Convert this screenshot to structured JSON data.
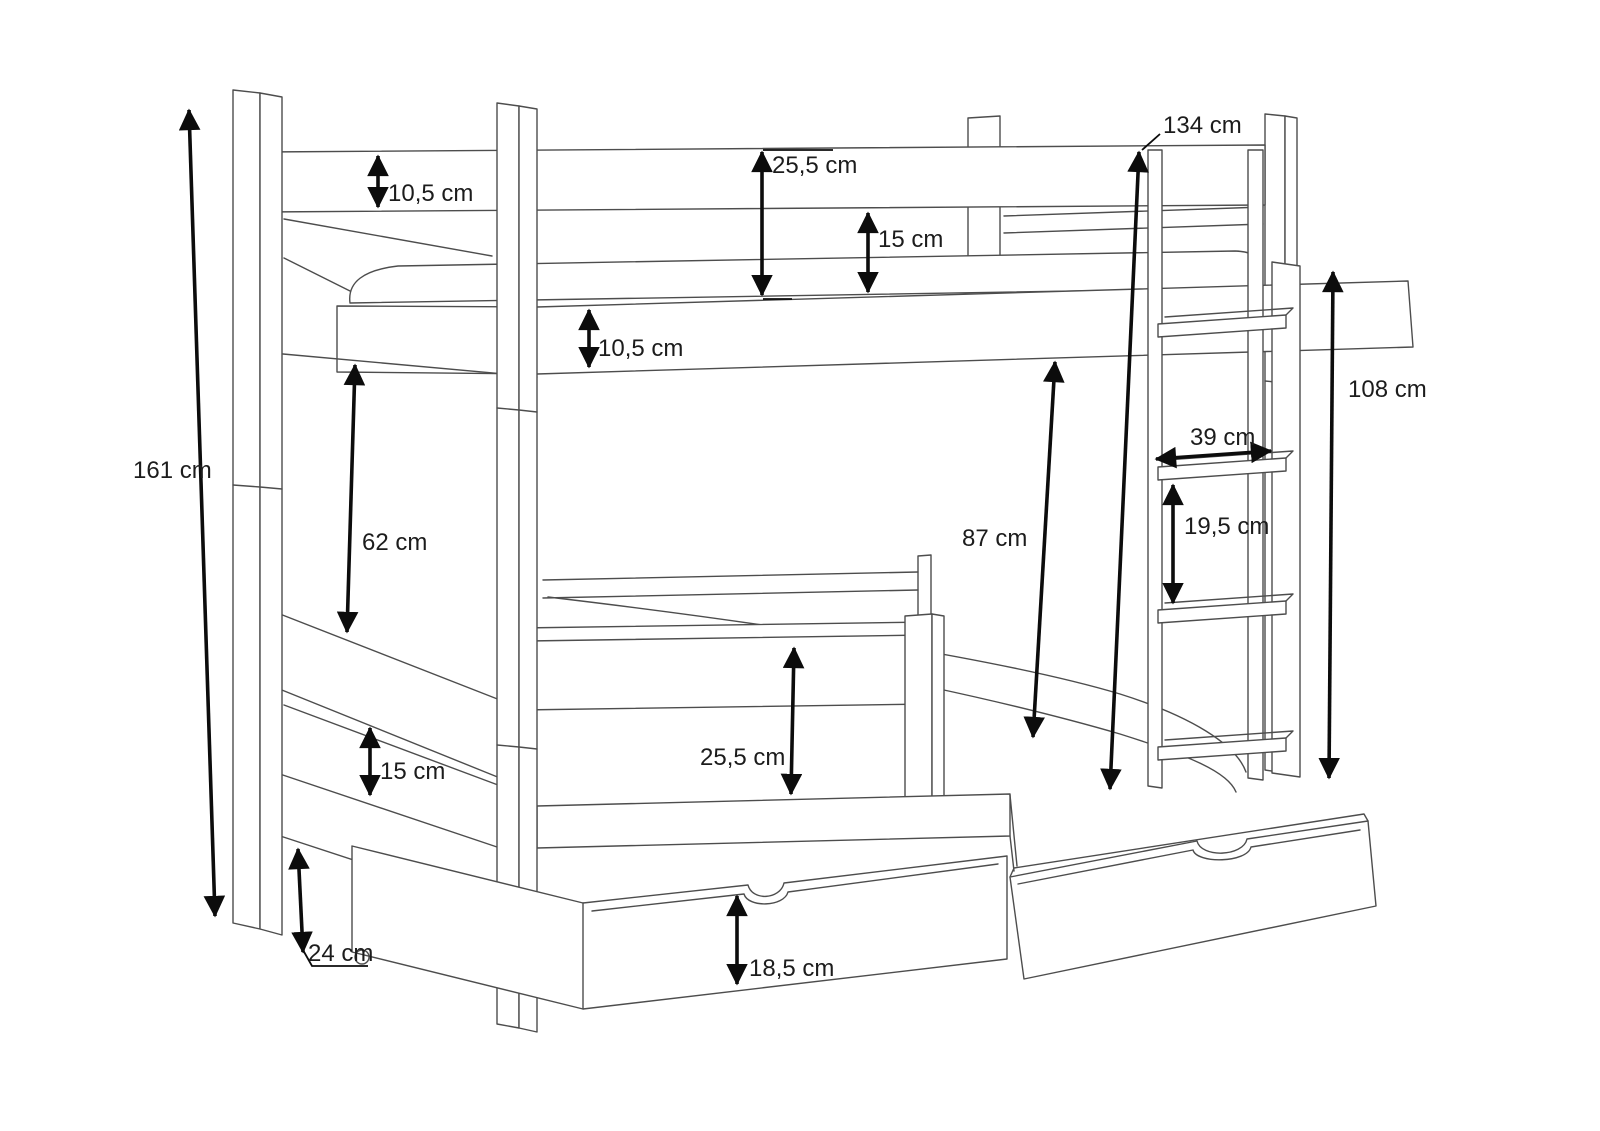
{
  "page": {
    "background": "#ffffff",
    "kind": "furniture dimension diagram",
    "subject": "bunk bed with two storage drawers and side ladder"
  },
  "diagram": {
    "line_color": "#4d4d4d",
    "dimension_color": "#0c0c0c",
    "unit": "cm",
    "labels": {
      "total_height": {
        "text": "161 cm",
        "meaning": "total height of bed posts"
      },
      "upper_top_rail": {
        "text": "10,5 cm",
        "meaning": "upper guard rail board height"
      },
      "upper_rail_to_frame": {
        "text": "25,5 cm",
        "meaning": "top rail to upper frame"
      },
      "upper_gap": {
        "text": "15 cm",
        "meaning": "gap under upper guard rail"
      },
      "upper_frame_rail": {
        "text": "10,5 cm",
        "meaning": "upper frame board height"
      },
      "rail_to_base": {
        "text": "134 cm",
        "meaning": "top rail down to base"
      },
      "ladder_height": {
        "text": "108 cm",
        "meaning": "ladder / handrail height"
      },
      "ladder_width": {
        "text": "39 cm",
        "meaning": "ladder width"
      },
      "rung_spacing": {
        "text": "19,5 cm",
        "meaning": "spacing between rungs"
      },
      "bunk_clearance": {
        "text": "87 cm",
        "meaning": "clearance above lower mattress"
      },
      "upper_to_lower": {
        "text": "62 cm",
        "meaning": "upper frame to lower bunk rail"
      },
      "lower_guard": {
        "text": "25,5 cm",
        "meaning": "lower guard rail to frame"
      },
      "lower_gap": {
        "text": "15 cm",
        "meaning": "gap under lower rail"
      },
      "drawer_height": {
        "text": "18,5 cm",
        "meaning": "storage drawer height"
      },
      "floor_clearance": {
        "text": "24 cm",
        "meaning": "floor clearance under bed"
      }
    }
  }
}
